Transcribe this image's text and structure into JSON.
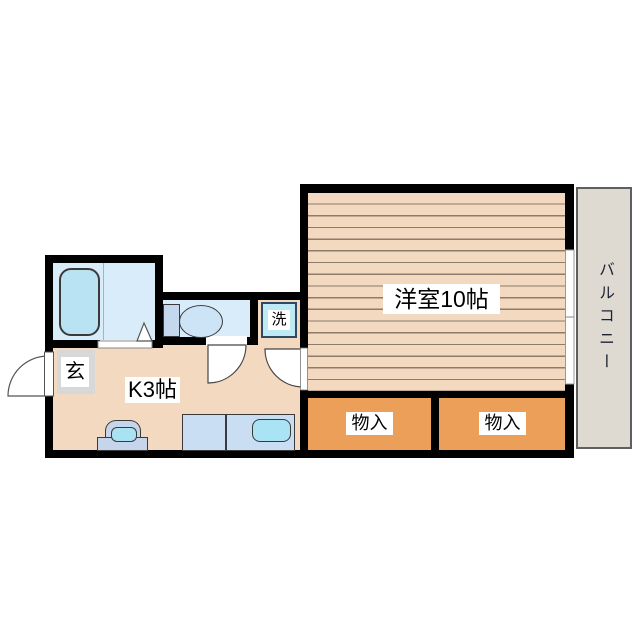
{
  "floorplan": {
    "type": "japanese-apartment-floor-plan",
    "labels": {
      "living": "洋室10帖",
      "kitchen": "K3帖",
      "balcony": "バルコニー",
      "storage_left": "物入",
      "storage_right": "物入",
      "entrance": "玄",
      "laundry": "洗"
    },
    "colors": {
      "wall": "#000000",
      "floor": "#f3d9bf",
      "floor_stripe": "#8d7b6b",
      "storage": "#ec9f58",
      "wet_area_floor": "#d9ecfa",
      "bathtub": "#b9e3f3",
      "counter": "#c9def2",
      "sink": "#aae3f3",
      "balcony": "#dedad2",
      "entrance": "#d8d8d8"
    },
    "icons": [
      "bathtub-icon",
      "toilet-icon",
      "washing-machine-icon",
      "kitchen-counter-icon",
      "kitchen-sink-icon",
      "stove-icon",
      "door-swing-icon",
      "sliding-window-icon",
      "entry-door-icon"
    ]
  }
}
